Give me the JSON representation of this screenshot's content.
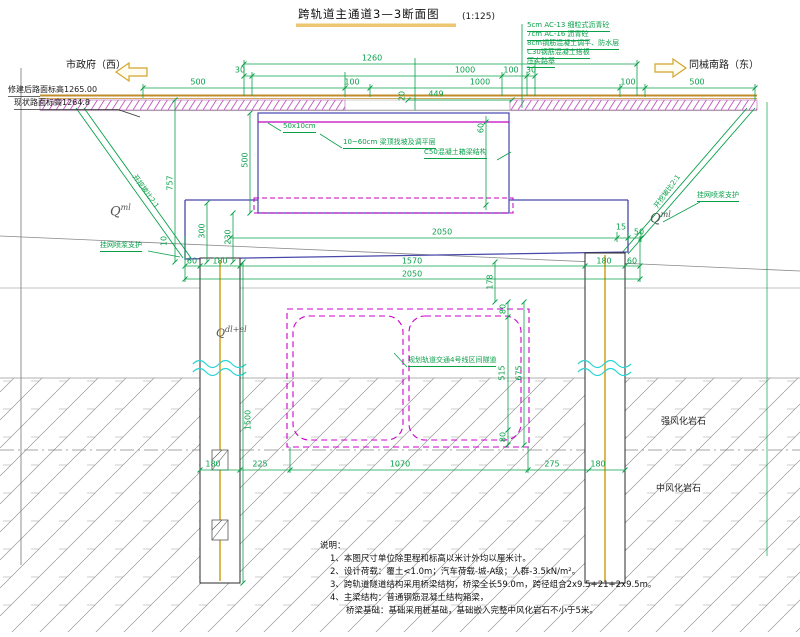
{
  "title": {
    "text": "跨轨道主通道3—3断面图",
    "scale": "(1:125)"
  },
  "directions": {
    "west": "市政府（西）",
    "east": "同械南路（东）"
  },
  "elevations": {
    "new_road": "修建后路面标高1265.00",
    "existing_road": "现状路面标高1264.8"
  },
  "pavement_notes": [
    "5cm AC-13 细粒式沥青砼",
    "7cm AC-16 沥青砼",
    "8cm钢筋混凝土调平、防水层",
    "C30钢筋混凝土搭板",
    "压实路基"
  ],
  "labels": {
    "curb": "50x10cm",
    "leveling": "10~60cm 梁顶找坡及调平层",
    "box_girder": "C50混凝土箱梁结构",
    "metro": "规划轨道交通4号线区间隧道",
    "shotcrete_left": "挂网喷浆支护",
    "shotcrete_right": "挂网喷浆支护",
    "slope_left": "开挖坡比2:1",
    "slope_right": "开挖坡比2:1",
    "rock_strong": "强风化岩石",
    "rock_medium": "中风化岩石"
  },
  "geology": {
    "q_base": "Q",
    "qml_sup": "ml",
    "qdl_sup": "dl+el"
  },
  "dims": {
    "d1260": "1260",
    "d30a": "30",
    "d1000a": "1000",
    "d100a": "100",
    "d30b": "30",
    "d500L": "500",
    "d100L": "100",
    "d1000b": "1000",
    "d100R": "100",
    "d500R": "500",
    "d20": "20",
    "d449": "449",
    "d60box": "60",
    "d500box": "500",
    "d757": "757",
    "d300": "300",
    "d230": "230",
    "d10": "10",
    "d2050a": "2050",
    "d15": "15",
    "d50": "50",
    "d60L": "60",
    "d180L": "180",
    "d1570": "1570",
    "d180R": "180",
    "d60R": "60",
    "d2050b": "2050",
    "d178": "178",
    "d80t": "80",
    "d515": "515",
    "d675": "675",
    "d80b": "80",
    "d1500": "1500",
    "b180L": "180",
    "b225": "225",
    "b1070": "1070",
    "b275": "275",
    "b180R": "180"
  },
  "notes": {
    "heading": "说明：",
    "items": [
      "1、本图尺寸单位除里程和标高以米计外均以厘米计。",
      "2、设计荷载：覆土<1.0m；汽车荷载-城-A级；人群-3.5kN/m²。",
      "3、跨轨道隧道结构采用桥梁结构，桥梁全长59.0m，跨径组合2x9.5+21+2x9.5m。",
      "4、主梁结构：普通钢筋混凝土结构箱梁，",
      "桥梁基础：基础采用桩基础，基础嵌入完整中风化岩石不小于5米。"
    ]
  }
}
